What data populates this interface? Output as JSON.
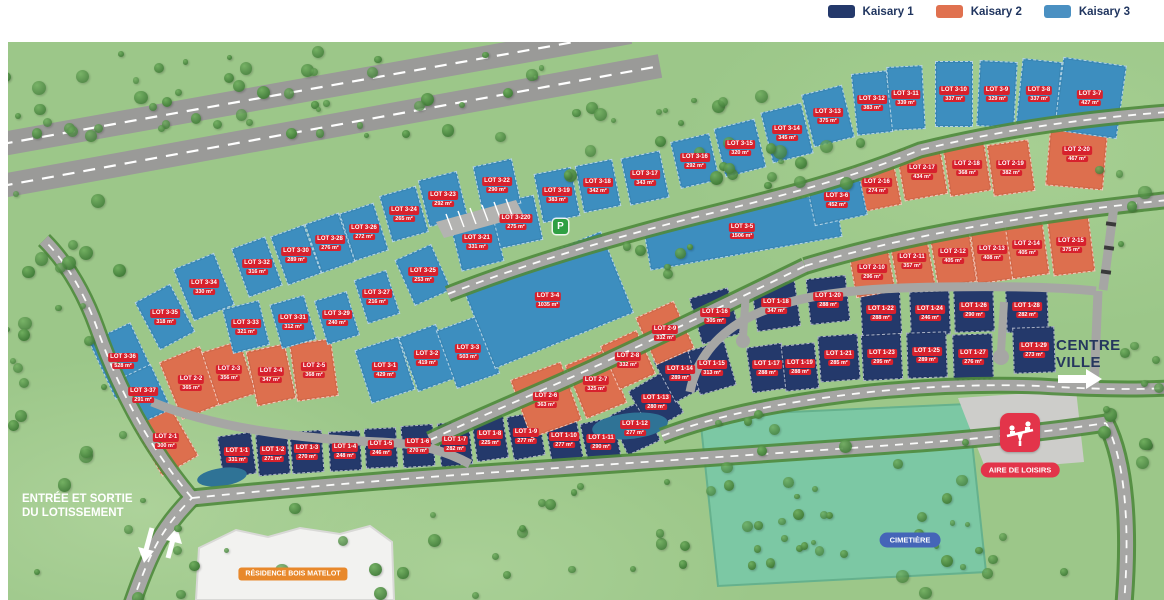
{
  "legend": {
    "items": [
      {
        "label": "Kaisary 1",
        "color": "#24396b"
      },
      {
        "label": "Kaisary 2",
        "color": "#e0714f"
      },
      {
        "label": "Kaisary 3",
        "color": "#4a90c2"
      }
    ]
  },
  "labels": {
    "entrance_line1": "ENTRÉE ET SORTIE",
    "entrance_line2": "DU LOTISSEMENT",
    "centre_line1": "CENTRE",
    "centre_line2": "VILLE",
    "aire_de_loisirs": "AIRE DE LOISIRS",
    "cimetiere": "CIMETIÈRE",
    "residence": "RÉSIDENCE BOIS MATELOT",
    "parking_p": "P"
  },
  "phases": {
    "1": {
      "name": "Kaisary 1",
      "color": "#24396b"
    },
    "2": {
      "name": "Kaisary 2",
      "color": "#dd6f4e"
    },
    "3": {
      "name": "Kaisary 3",
      "color": "#3d8ebf"
    }
  },
  "lots_fields": [
    "id",
    "area",
    "phase",
    "x",
    "y",
    "w",
    "h",
    "rotation_deg"
  ],
  "lots": [
    [
      "LOT 1-1",
      "331 m²",
      1,
      237,
      455,
      34,
      42,
      -8
    ],
    [
      "LOT 1-2",
      "271 m²",
      1,
      273,
      454,
      32,
      42,
      -5
    ],
    [
      "LOT 1-3",
      "270 m²",
      1,
      307,
      452,
      32,
      42,
      -4
    ],
    [
      "LOT 1-4",
      "248 m²",
      1,
      345,
      451,
      32,
      40,
      -3
    ],
    [
      "LOT 1-5",
      "246 m²",
      1,
      381,
      448,
      32,
      40,
      -3
    ],
    [
      "LOT 1-6",
      "270 m²",
      1,
      418,
      446,
      32,
      42,
      -4
    ],
    [
      "LOT 1-7",
      "282 m²",
      1,
      455,
      444,
      32,
      44,
      -6
    ],
    [
      "LOT 1-8",
      "225 m²",
      1,
      490,
      438,
      32,
      44,
      -8
    ],
    [
      "LOT 1-9",
      "277 m²",
      1,
      526,
      436,
      32,
      44,
      -10
    ],
    [
      "LOT 1-10",
      "277 m²",
      1,
      564,
      440,
      32,
      44,
      -10
    ],
    [
      "LOT 1-11",
      "290 m²",
      1,
      601,
      442,
      34,
      44,
      -12
    ],
    [
      "LOT 1-12",
      "277 m²",
      1,
      635,
      428,
      36,
      44,
      -25
    ],
    [
      "LOT 1-13",
      "280 m²",
      1,
      656,
      402,
      38,
      46,
      -30
    ],
    [
      "LOT 1-14",
      "289 m²",
      1,
      680,
      373,
      36,
      48,
      -28
    ],
    [
      "LOT 1-15",
      "313 m²",
      1,
      712,
      368,
      38,
      46,
      -16
    ],
    [
      "LOT 1-16",
      "305 m²",
      1,
      715,
      316,
      40,
      48,
      -16
    ],
    [
      "LOT 1-17",
      "288 m²",
      1,
      767,
      368,
      36,
      46,
      -8
    ],
    [
      "LOT 1-18",
      "347 m²",
      1,
      776,
      306,
      44,
      46,
      -8
    ],
    [
      "LOT 1-19",
      "288 m²",
      1,
      800,
      367,
      34,
      46,
      -6
    ],
    [
      "LOT 1-20",
      "288 m²",
      1,
      828,
      300,
      40,
      46,
      -6
    ],
    [
      "LOT 1-21",
      "285 m²",
      1,
      839,
      358,
      40,
      46,
      -4
    ],
    [
      "LOT 1-22",
      "288 m²",
      1,
      881,
      313,
      40,
      44,
      -3
    ],
    [
      "LOT 1-23",
      "295 m²",
      1,
      882,
      357,
      40,
      46,
      -3
    ],
    [
      "LOT 1-24",
      "246 m²",
      1,
      930,
      313,
      40,
      44,
      -2
    ],
    [
      "LOT 1-25",
      "289 m²",
      1,
      927,
      355,
      40,
      46,
      -2
    ],
    [
      "LOT 1-26",
      "290 m²",
      1,
      974,
      310,
      40,
      44,
      -2
    ],
    [
      "LOT 1-27",
      "276 m²",
      1,
      973,
      357,
      40,
      46,
      -2
    ],
    [
      "LOT 1-28",
      "282 m²",
      1,
      1027,
      310,
      42,
      44,
      -2
    ],
    [
      "LOT 1-29",
      "273 m²",
      1,
      1034,
      350,
      42,
      46,
      -2
    ],
    [
      "LOT 2-1",
      "300 m²",
      2,
      166,
      441,
      42,
      58,
      -30
    ],
    [
      "LOT 2-2",
      "365 m²",
      2,
      191,
      383,
      44,
      62,
      -22
    ],
    [
      "LOT 2-3",
      "356 m²",
      2,
      229,
      373,
      40,
      56,
      -18
    ],
    [
      "LOT 2-4",
      "347 m²",
      2,
      271,
      375,
      40,
      56,
      -12
    ],
    [
      "LOT 2-5",
      "368 m²",
      2,
      314,
      370,
      42,
      58,
      -8
    ],
    [
      "LOT 2-6",
      "363 m²",
      2,
      546,
      400,
      54,
      62,
      -20
    ],
    [
      "LOT 2-7",
      "325 m²",
      2,
      596,
      384,
      44,
      58,
      -22
    ],
    [
      "LOT 2-8",
      "332 m²",
      2,
      628,
      360,
      40,
      48,
      -24
    ],
    [
      "LOT 2-9",
      "332 m²",
      2,
      665,
      333,
      42,
      52,
      -24
    ],
    [
      "LOT 2-10",
      "296 m²",
      2,
      872,
      272,
      40,
      46,
      -10
    ],
    [
      "LOT 2-11",
      "357 m²",
      2,
      912,
      261,
      38,
      56,
      -10
    ],
    [
      "LOT 2-12",
      "405 m²",
      2,
      953,
      256,
      40,
      58,
      -9
    ],
    [
      "LOT 2-13",
      "408 m²",
      2,
      992,
      253,
      38,
      58,
      -8
    ],
    [
      "LOT 2-14",
      "405 m²",
      2,
      1027,
      248,
      38,
      58,
      -8
    ],
    [
      "LOT 2-15",
      "375 m²",
      2,
      1071,
      245,
      42,
      58,
      -7
    ],
    [
      "LOT 2-16",
      "274 m²",
      2,
      877,
      186,
      42,
      46,
      -11
    ],
    [
      "LOT 2-17",
      "434 m²",
      2,
      922,
      172,
      44,
      52,
      -10
    ],
    [
      "LOT 2-18",
      "368 m²",
      2,
      967,
      168,
      42,
      52,
      -9
    ],
    [
      "LOT 2-19",
      "382 m²",
      2,
      1011,
      168,
      42,
      52,
      -8
    ],
    [
      "LOT 2-20",
      "467 m²",
      2,
      1077,
      154,
      58,
      68,
      5
    ],
    [
      "LOT 3-1",
      "429 m²",
      3,
      385,
      370,
      46,
      56,
      -18
    ],
    [
      "LOT 3-2",
      "419 m²",
      3,
      427,
      358,
      40,
      58,
      -20
    ],
    [
      "LOT 3-3",
      "503 m²",
      3,
      468,
      352,
      46,
      62,
      -20
    ],
    [
      "LOT 3-4",
      "1035 m²",
      3,
      548,
      300,
      150,
      88,
      -22
    ],
    [
      "LOT 3-5",
      "1506 m²",
      3,
      742,
      231,
      195,
      46,
      -10
    ],
    [
      "LOT 3-6",
      "452 m²",
      3,
      837,
      200,
      54,
      42,
      -12
    ],
    [
      "LOT 3-7",
      "427 m²",
      3,
      1090,
      98,
      64,
      74,
      8
    ],
    [
      "LOT 3-8",
      "337 m²",
      3,
      1039,
      94,
      40,
      68,
      6
    ],
    [
      "LOT 3-9",
      "329 m²",
      3,
      997,
      94,
      38,
      66,
      3
    ],
    [
      "LOT 3-10",
      "337 m²",
      3,
      954,
      94,
      38,
      66,
      0
    ],
    [
      "LOT 3-11",
      "339 m²",
      3,
      906,
      98,
      36,
      64,
      -3
    ],
    [
      "LOT 3-12",
      "383 m²",
      3,
      872,
      103,
      36,
      62,
      -6
    ],
    [
      "LOT 3-13",
      "375 m²",
      3,
      828,
      116,
      42,
      54,
      -14
    ],
    [
      "LOT 3-14",
      "345 m²",
      3,
      787,
      133,
      42,
      52,
      -14
    ],
    [
      "LOT 3-15",
      "320 m²",
      3,
      740,
      148,
      42,
      50,
      -14
    ],
    [
      "LOT 3-16",
      "292 m²",
      3,
      695,
      161,
      40,
      48,
      -13
    ],
    [
      "LOT 3-17",
      "343 m²",
      3,
      645,
      178,
      40,
      48,
      -12
    ],
    [
      "LOT 3-18",
      "342 m²",
      3,
      598,
      186,
      38,
      48,
      -11
    ],
    [
      "LOT 3-19",
      "383 m²",
      3,
      557,
      195,
      38,
      50,
      -11
    ],
    [
      "LOT 3-220",
      "275 m²",
      3,
      516,
      222,
      46,
      46,
      -12
    ],
    [
      "LOT 3-21",
      "331 m²",
      3,
      477,
      242,
      44,
      50,
      -14
    ],
    [
      "LOT 3-22",
      "290 m²",
      3,
      497,
      185,
      40,
      46,
      -12
    ],
    [
      "LOT 3-23",
      "292 m²",
      3,
      443,
      199,
      40,
      48,
      -14
    ],
    [
      "LOT 3-24",
      "265 m²",
      3,
      404,
      214,
      38,
      48,
      -16
    ],
    [
      "LOT 3-25",
      "253 m²",
      3,
      423,
      275,
      40,
      50,
      -24
    ],
    [
      "LOT 3-26",
      "272 m²",
      3,
      364,
      232,
      36,
      50,
      -18
    ],
    [
      "LOT 3-27",
      "216 m²",
      3,
      377,
      297,
      34,
      46,
      -18
    ],
    [
      "LOT 3-28",
      "276 m²",
      3,
      330,
      243,
      36,
      52,
      -19
    ],
    [
      "LOT 3-29",
      "240 m²",
      3,
      337,
      318,
      34,
      46,
      -17
    ],
    [
      "LOT 3-30",
      "289 m²",
      3,
      296,
      255,
      36,
      52,
      -20
    ],
    [
      "LOT 3-31",
      "312 m²",
      3,
      293,
      322,
      36,
      46,
      -16
    ],
    [
      "LOT 3-32",
      "316 m²",
      3,
      257,
      267,
      36,
      52,
      -20
    ],
    [
      "LOT 3-33",
      "321 m²",
      3,
      246,
      327,
      38,
      46,
      -14
    ],
    [
      "LOT 3-34",
      "330 m²",
      3,
      204,
      287,
      44,
      56,
      -22
    ],
    [
      "LOT 3-35",
      "318 m²",
      3,
      165,
      317,
      40,
      54,
      -28
    ],
    [
      "LOT 3-36",
      "528 m²",
      3,
      123,
      361,
      46,
      64,
      -25
    ],
    [
      "LOT 3-37",
      "291 m²",
      3,
      143,
      395,
      40,
      50,
      -25
    ]
  ]
}
